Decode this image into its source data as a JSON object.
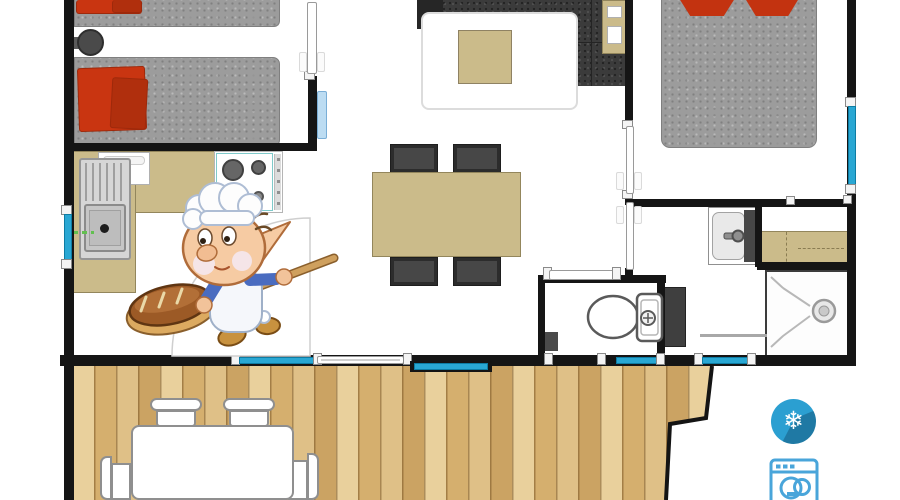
{
  "scene": {
    "type": "floor-plan-image",
    "subject": "mobile-home floor plan with terrace, furniture and a cartoon baker mascot"
  },
  "icons": {
    "air_conditioning": {
      "name": "snowflake-icon",
      "glyph": "❄",
      "circle_color": "#2b9fd1",
      "shadow_color": "#15719f",
      "glyph_color": "#ffffff"
    },
    "dishwasher": {
      "name": "dishwasher-icon",
      "stroke_color": "#49a5da"
    }
  },
  "amenities_shown": [
    "air-conditioning",
    "dishwasher"
  ],
  "palette": {
    "wall": "#151515",
    "floor": "#ffffff",
    "bed_grey": "#9c9c9c",
    "pillow_red": "#c93511",
    "sofa_charcoal": "#3b3b3b",
    "wood_counter": "#cbbb8a",
    "glazing_blue": "#29a7d3",
    "terrace_wood": "#dcbc84",
    "tv_screen": "#bcdcf2"
  },
  "rooms": [
    {
      "id": "bedroom-twin",
      "furniture": [
        "single-bed",
        "single-bed",
        "round-nightstand"
      ]
    },
    {
      "id": "kitchen",
      "furniture": [
        "fridge",
        "gas-hob",
        "sink",
        "worktop"
      ]
    },
    {
      "id": "living-dining",
      "furniture": [
        "corner-sofa",
        "coffee-table",
        "rug",
        "wall-tv",
        "dining-table",
        "chair",
        "chair",
        "chair",
        "chair"
      ]
    },
    {
      "id": "bedroom-master",
      "furniture": [
        "double-bed",
        "wardrobe"
      ]
    },
    {
      "id": "bathroom",
      "furniture": [
        "washbasin",
        "worktop",
        "shower"
      ]
    },
    {
      "id": "wc",
      "furniture": [
        "toilet"
      ]
    },
    {
      "id": "terrace",
      "furniture": [
        "outdoor-table",
        "outdoor-chair",
        "outdoor-chair",
        "outdoor-chair",
        "outdoor-chair"
      ]
    }
  ]
}
